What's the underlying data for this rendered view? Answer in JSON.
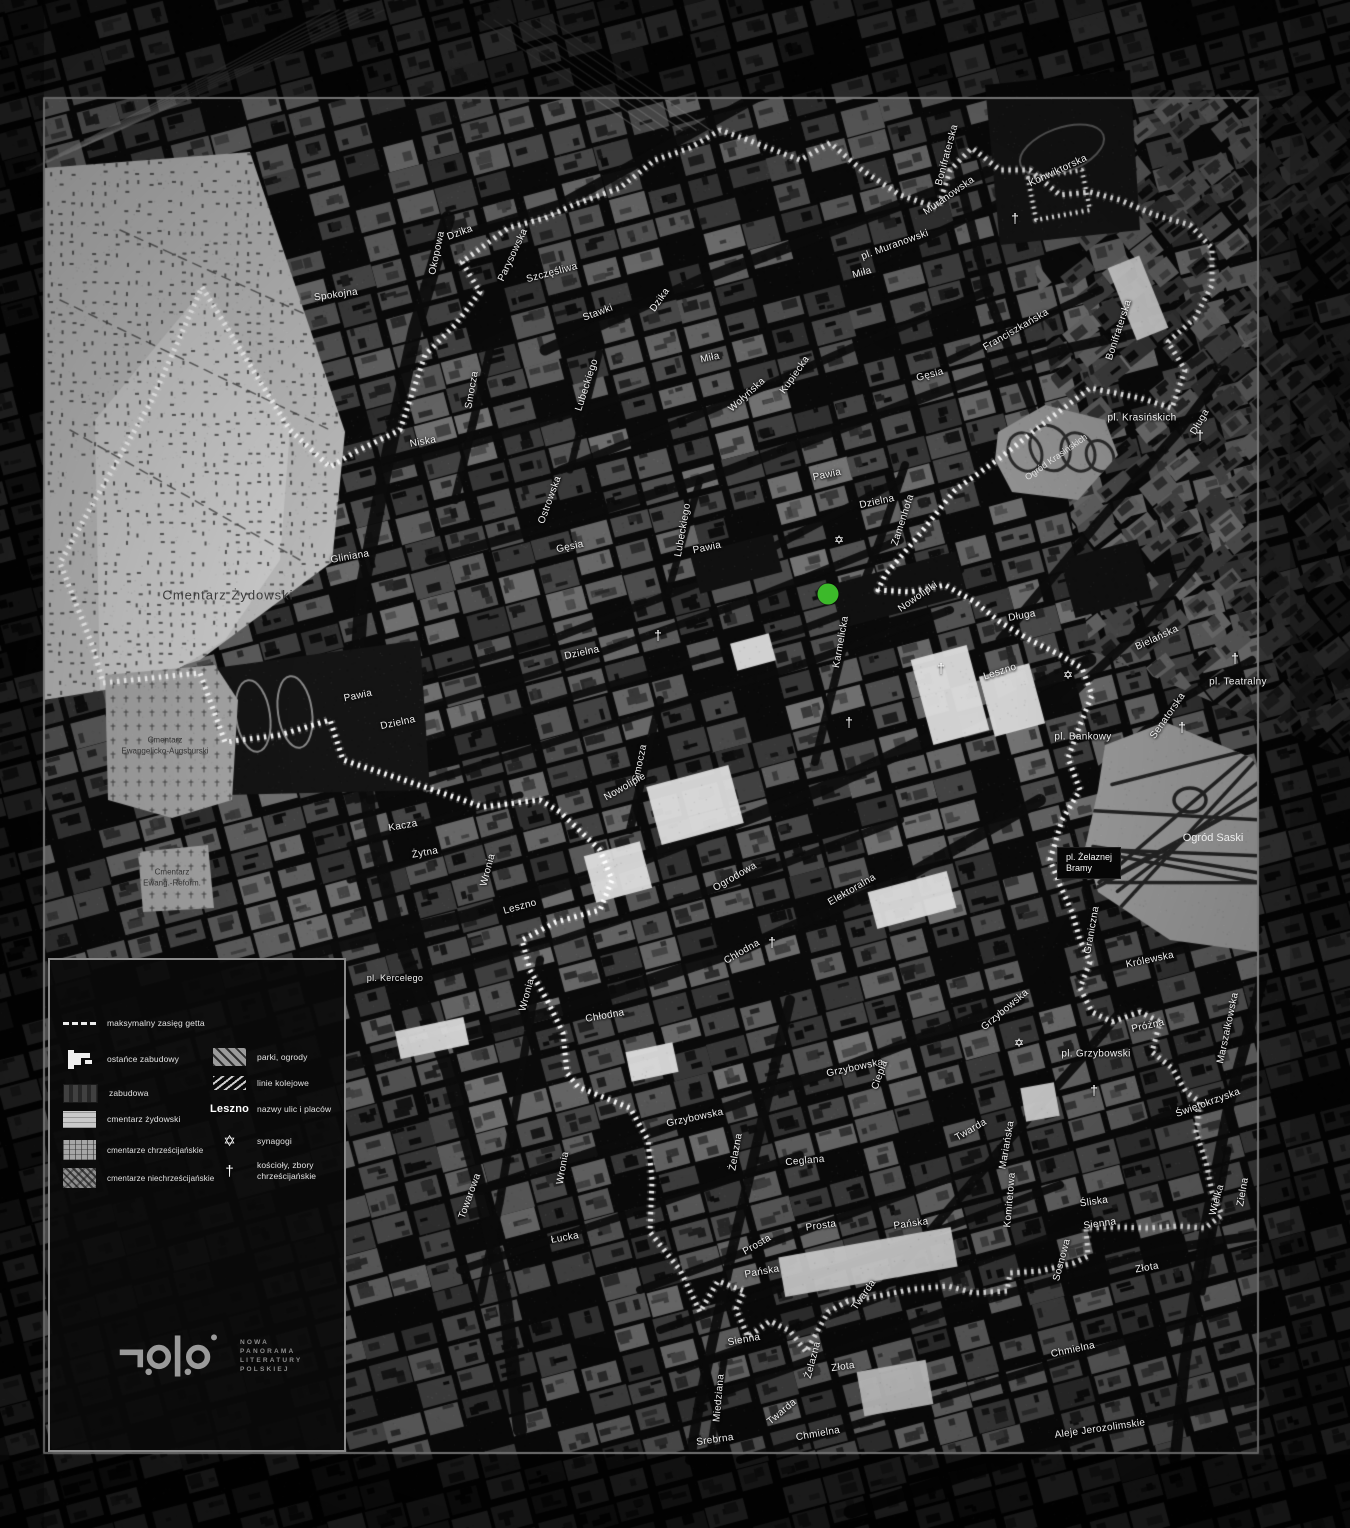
{
  "map": {
    "marker": {
      "x": 828,
      "y": 594,
      "color": "#3cb92a"
    },
    "street_labels": [
      {
        "t": "Dzika",
        "x": 460,
        "y": 233,
        "r": -20
      },
      {
        "t": "Okopowa",
        "x": 437,
        "y": 253,
        "r": -78
      },
      {
        "t": "Spokojna",
        "x": 336,
        "y": 295,
        "r": -8
      },
      {
        "t": "Parysowska",
        "x": 513,
        "y": 255,
        "r": -65
      },
      {
        "t": "Szczęśliwa",
        "x": 552,
        "y": 273,
        "r": -15
      },
      {
        "t": "Stawki",
        "x": 598,
        "y": 313,
        "r": -20
      },
      {
        "t": "Dzika",
        "x": 660,
        "y": 300,
        "r": -55
      },
      {
        "t": "Smocza",
        "x": 472,
        "y": 390,
        "r": -80
      },
      {
        "t": "Niska",
        "x": 423,
        "y": 442,
        "r": -10
      },
      {
        "t": "Lubeckiego",
        "x": 587,
        "y": 385,
        "r": -72
      },
      {
        "t": "Lubeckiego",
        "x": 683,
        "y": 530,
        "r": -80
      },
      {
        "t": "Ostrowska",
        "x": 550,
        "y": 500,
        "r": -70
      },
      {
        "t": "Miła",
        "x": 710,
        "y": 358,
        "r": -12
      },
      {
        "t": "Miła",
        "x": 862,
        "y": 273,
        "r": -15
      },
      {
        "t": "Wołyńska",
        "x": 747,
        "y": 395,
        "r": -42
      },
      {
        "t": "Kupiecka",
        "x": 795,
        "y": 375,
        "r": -55
      },
      {
        "t": "Gęsia",
        "x": 930,
        "y": 375,
        "r": -15
      },
      {
        "t": "Gęsia",
        "x": 570,
        "y": 547,
        "r": -12
      },
      {
        "t": "Muranowska",
        "x": 949,
        "y": 196,
        "r": -35
      },
      {
        "t": "pl. Muranowski",
        "x": 895,
        "y": 245,
        "r": -20
      },
      {
        "t": "Konwiktorska",
        "x": 1058,
        "y": 171,
        "r": -25
      },
      {
        "t": "Bonifraterska",
        "x": 947,
        "y": 155,
        "r": -75
      },
      {
        "t": "Bonifraterska",
        "x": 1119,
        "y": 330,
        "r": -72
      },
      {
        "t": "Franciszkańska",
        "x": 1016,
        "y": 330,
        "r": -30
      },
      {
        "t": "Pawia",
        "x": 707,
        "y": 548,
        "r": -12
      },
      {
        "t": "Pawia",
        "x": 827,
        "y": 475,
        "r": -12
      },
      {
        "t": "Pawia",
        "x": 358,
        "y": 696,
        "r": -12
      },
      {
        "t": "Dzielna",
        "x": 877,
        "y": 502,
        "r": -12
      },
      {
        "t": "Dzielna",
        "x": 582,
        "y": 653,
        "r": -12
      },
      {
        "t": "Dzielna",
        "x": 398,
        "y": 723,
        "r": -12
      },
      {
        "t": "Zamenhofa",
        "x": 903,
        "y": 520,
        "r": -72
      },
      {
        "t": "Nowolipki",
        "x": 918,
        "y": 597,
        "r": -35
      },
      {
        "t": "Karmelicka",
        "x": 841,
        "y": 642,
        "r": -80
      },
      {
        "t": "Długa",
        "x": 1022,
        "y": 616,
        "r": -10
      },
      {
        "t": "Długa",
        "x": 1200,
        "y": 422,
        "r": -60
      },
      {
        "t": "Leszno",
        "x": 1000,
        "y": 672,
        "r": -18
      },
      {
        "t": "Leszno",
        "x": 520,
        "y": 907,
        "r": -15
      },
      {
        "t": "pl. Bankowy",
        "x": 1083,
        "y": 737,
        "r": 0
      },
      {
        "t": "pl. Krasińskich",
        "x": 1142,
        "y": 418,
        "r": 0
      },
      {
        "t": "Bielańska",
        "x": 1157,
        "y": 638,
        "r": -25
      },
      {
        "t": "pl. Teatralny",
        "x": 1238,
        "y": 682,
        "r": 0
      },
      {
        "t": "Senatorska",
        "x": 1168,
        "y": 716,
        "r": -55
      },
      {
        "t": "Graniczna",
        "x": 1092,
        "y": 930,
        "r": -80
      },
      {
        "t": "Królewska",
        "x": 1150,
        "y": 960,
        "r": -12
      },
      {
        "t": "Gliniana",
        "x": 350,
        "y": 557,
        "r": -10
      },
      {
        "t": "Kacza",
        "x": 403,
        "y": 826,
        "r": -10
      },
      {
        "t": "Żytna",
        "x": 425,
        "y": 853,
        "r": -10
      },
      {
        "t": "Wronia",
        "x": 488,
        "y": 870,
        "r": -75
      },
      {
        "t": "Wronia",
        "x": 527,
        "y": 995,
        "r": -75
      },
      {
        "t": "Wronia",
        "x": 563,
        "y": 1168,
        "r": -80
      },
      {
        "t": "Smocza",
        "x": 640,
        "y": 763,
        "r": -78
      },
      {
        "t": "Nowolipie",
        "x": 625,
        "y": 787,
        "r": -30
      },
      {
        "t": "Ogrodowa",
        "x": 735,
        "y": 877,
        "r": -30
      },
      {
        "t": "Elektoralna",
        "x": 852,
        "y": 890,
        "r": -30
      },
      {
        "t": "Chłodna",
        "x": 742,
        "y": 952,
        "r": -30
      },
      {
        "t": "Chłodna",
        "x": 605,
        "y": 1016,
        "r": -10
      },
      {
        "t": "pl. Kercelego",
        "x": 395,
        "y": 978,
        "r": 0,
        "s": 9
      },
      {
        "t": "Towarowa",
        "x": 470,
        "y": 1196,
        "r": -70
      },
      {
        "t": "Łucka",
        "x": 565,
        "y": 1238,
        "r": -10
      },
      {
        "t": "Grzybowska",
        "x": 695,
        "y": 1118,
        "r": -12
      },
      {
        "t": "Grzybowska",
        "x": 855,
        "y": 1068,
        "r": -12
      },
      {
        "t": "Grzybowska",
        "x": 1005,
        "y": 1010,
        "r": -40
      },
      {
        "t": "Żelazna",
        "x": 736,
        "y": 1152,
        "r": -80
      },
      {
        "t": "Żelazna",
        "x": 813,
        "y": 1360,
        "r": -75
      },
      {
        "t": "Ceglana",
        "x": 805,
        "y": 1161,
        "r": -5
      },
      {
        "t": "Prosta",
        "x": 821,
        "y": 1226,
        "r": -8
      },
      {
        "t": "Prosta",
        "x": 757,
        "y": 1245,
        "r": -30
      },
      {
        "t": "Pańska",
        "x": 911,
        "y": 1224,
        "r": -8
      },
      {
        "t": "Pańska",
        "x": 762,
        "y": 1272,
        "r": -10
      },
      {
        "t": "Twarda",
        "x": 971,
        "y": 1130,
        "r": -30
      },
      {
        "t": "Twarda",
        "x": 864,
        "y": 1295,
        "r": -55
      },
      {
        "t": "Twarda",
        "x": 782,
        "y": 1412,
        "r": -40
      },
      {
        "t": "Ciepła",
        "x": 880,
        "y": 1075,
        "r": -70
      },
      {
        "t": "pl. Grzybowski",
        "x": 1096,
        "y": 1054,
        "r": 0
      },
      {
        "t": "Próżna",
        "x": 1148,
        "y": 1026,
        "r": -12
      },
      {
        "t": "Marszałkowska",
        "x": 1228,
        "y": 1028,
        "r": -78
      },
      {
        "t": "Świętokrzyska",
        "x": 1208,
        "y": 1103,
        "r": -20
      },
      {
        "t": "Zielna",
        "x": 1243,
        "y": 1192,
        "r": -80
      },
      {
        "t": "Wielka",
        "x": 1217,
        "y": 1200,
        "r": -75
      },
      {
        "t": "Śliska",
        "x": 1094,
        "y": 1202,
        "r": -8
      },
      {
        "t": "Sienna",
        "x": 1100,
        "y": 1224,
        "r": -8
      },
      {
        "t": "Sienna",
        "x": 744,
        "y": 1340,
        "r": -10
      },
      {
        "t": "Złota",
        "x": 843,
        "y": 1367,
        "r": -8
      },
      {
        "t": "Złota",
        "x": 1147,
        "y": 1268,
        "r": -10
      },
      {
        "t": "Sosnowa",
        "x": 1062,
        "y": 1260,
        "r": -75
      },
      {
        "t": "Mariańska",
        "x": 1007,
        "y": 1145,
        "r": -80
      },
      {
        "t": "Komitetowa",
        "x": 1010,
        "y": 1200,
        "r": -85
      },
      {
        "t": "Chmielna",
        "x": 818,
        "y": 1434,
        "r": -10
      },
      {
        "t": "Chmielna",
        "x": 1073,
        "y": 1350,
        "r": -12
      },
      {
        "t": "Miedziana",
        "x": 719,
        "y": 1398,
        "r": -85
      },
      {
        "t": "Srebrna",
        "x": 715,
        "y": 1440,
        "r": -8
      },
      {
        "t": "Aleje Jerozolimskie",
        "x": 1100,
        "y": 1429,
        "r": -8
      }
    ],
    "area_labels": [
      {
        "t": "Cmentarz Żydowski",
        "x": 228,
        "y": 595,
        "r": 0,
        "s": 13,
        "c": "#3a3a3a",
        "ls": 1
      },
      {
        "t": "Cmentarz",
        "x": 165,
        "y": 740,
        "r": 0,
        "s": 8,
        "c": "#333333"
      },
      {
        "t": "Ewangelicko-Augsburski",
        "x": 165,
        "y": 751,
        "r": 0,
        "s": 8,
        "c": "#333333"
      },
      {
        "t": "Cmentarz",
        "x": 172,
        "y": 872,
        "r": 0,
        "s": 8,
        "c": "#333333"
      },
      {
        "t": "Ewang.-Reform.",
        "x": 172,
        "y": 883,
        "r": 0,
        "s": 8,
        "c": "#333333"
      },
      {
        "t": "Ogród Krasińskich",
        "x": 1056,
        "y": 457,
        "r": -35,
        "s": 9,
        "c": "#dedede"
      },
      {
        "t": "Ogród Saski",
        "x": 1213,
        "y": 838,
        "r": 0,
        "s": 11,
        "c": "#ededed"
      }
    ],
    "place_boxes": [
      {
        "lines": [
          "pl. Żelaznej",
          "Bramy"
        ],
        "x": 1089,
        "y": 863
      }
    ],
    "synagogues": [
      [
        839,
        540
      ],
      [
        1068,
        675
      ],
      [
        1019,
        1043
      ]
    ],
    "churches": [
      [
        658,
        635
      ],
      [
        849,
        722
      ],
      [
        941,
        668
      ],
      [
        1094,
        1090
      ],
      [
        1182,
        727
      ],
      [
        1200,
        435
      ],
      [
        1235,
        658
      ],
      [
        772,
        942
      ],
      [
        1015,
        218
      ]
    ],
    "symbols": {
      "synagogue": "✡",
      "church": "†"
    }
  },
  "legend": {
    "items_left": [
      {
        "key": "ghetto-extent",
        "label": "maksymalny zasięg getta"
      },
      {
        "key": "remnant-buildings",
        "label": "ostańce zabudowy"
      },
      {
        "key": "buildings",
        "label": "zabudowa"
      },
      {
        "key": "jewish-cemetery",
        "label": "cmentarz żydowski"
      },
      {
        "key": "christian-cemeteries",
        "label": "cmentarze chrześcijańskie"
      },
      {
        "key": "non-christian-cemeteries",
        "label": "cmentarze niechrześcijańskie"
      }
    ],
    "items_right": [
      {
        "key": "parks",
        "label": "parki, ogrody"
      },
      {
        "key": "railways",
        "label": "linie kolejowe"
      },
      {
        "key": "street-names",
        "sample": "Leszno",
        "label": "nazwy ulic i placów"
      },
      {
        "key": "synagogues",
        "symbol": "✡",
        "label": "synagogi"
      },
      {
        "key": "churches",
        "symbol": "†",
        "label": "kościoły, zbory chrześcijańskie"
      }
    ]
  },
  "logo": {
    "text_lines": [
      "NOWA",
      "PANORAMA",
      "LITERATURY",
      "POLSKIEJ"
    ]
  },
  "colors": {
    "ghetto_line": "#ffffff",
    "frame": "#8f8f8f",
    "jewish_cemetery": "#c2c2c2",
    "marker_green": "#3cb92a"
  }
}
